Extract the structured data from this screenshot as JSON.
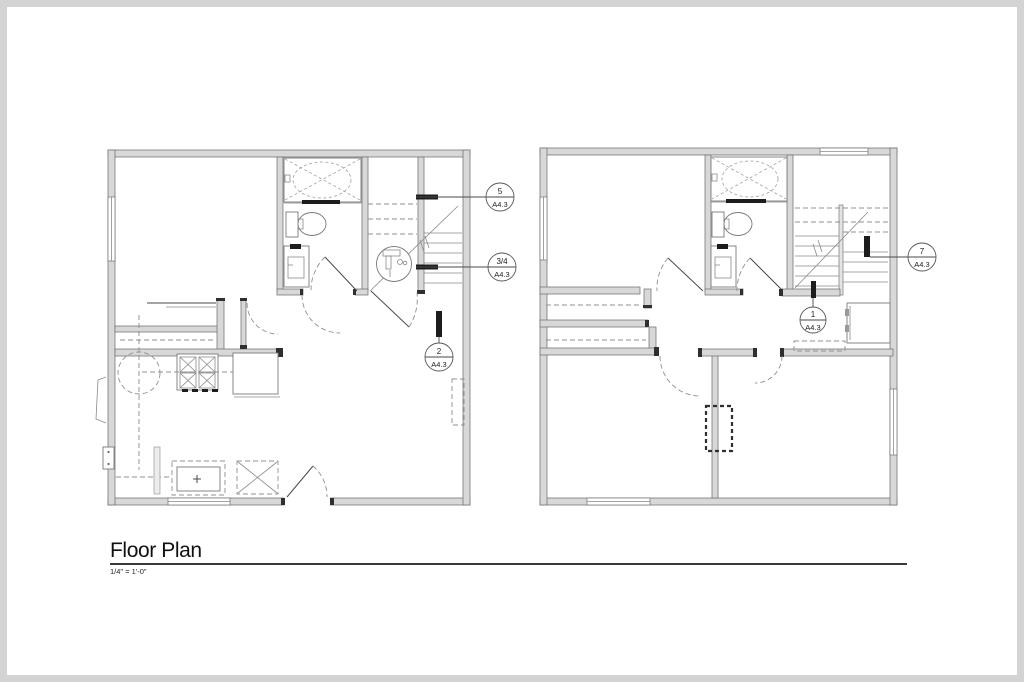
{
  "drawing": {
    "title": "Floor Plan",
    "scale": "1/4\" = 1'-0\""
  },
  "callouts": {
    "c5": {
      "number": "5",
      "sheet": "A4.3"
    },
    "c34": {
      "number": "3/4",
      "sheet": "A4.3"
    },
    "c2": {
      "number": "2",
      "sheet": "A4.3"
    },
    "c7": {
      "number": "7",
      "sheet": "A4.3"
    },
    "c1": {
      "number": "1",
      "sheet": "A4.3"
    }
  },
  "colors": {
    "wall_fill": "#d8d8d8",
    "wall_stroke": "#707070",
    "line": "#4a4a4a",
    "dashed_line": "#909090",
    "callout_text": "#1c1c1c",
    "frame": "#d3d3d3"
  }
}
